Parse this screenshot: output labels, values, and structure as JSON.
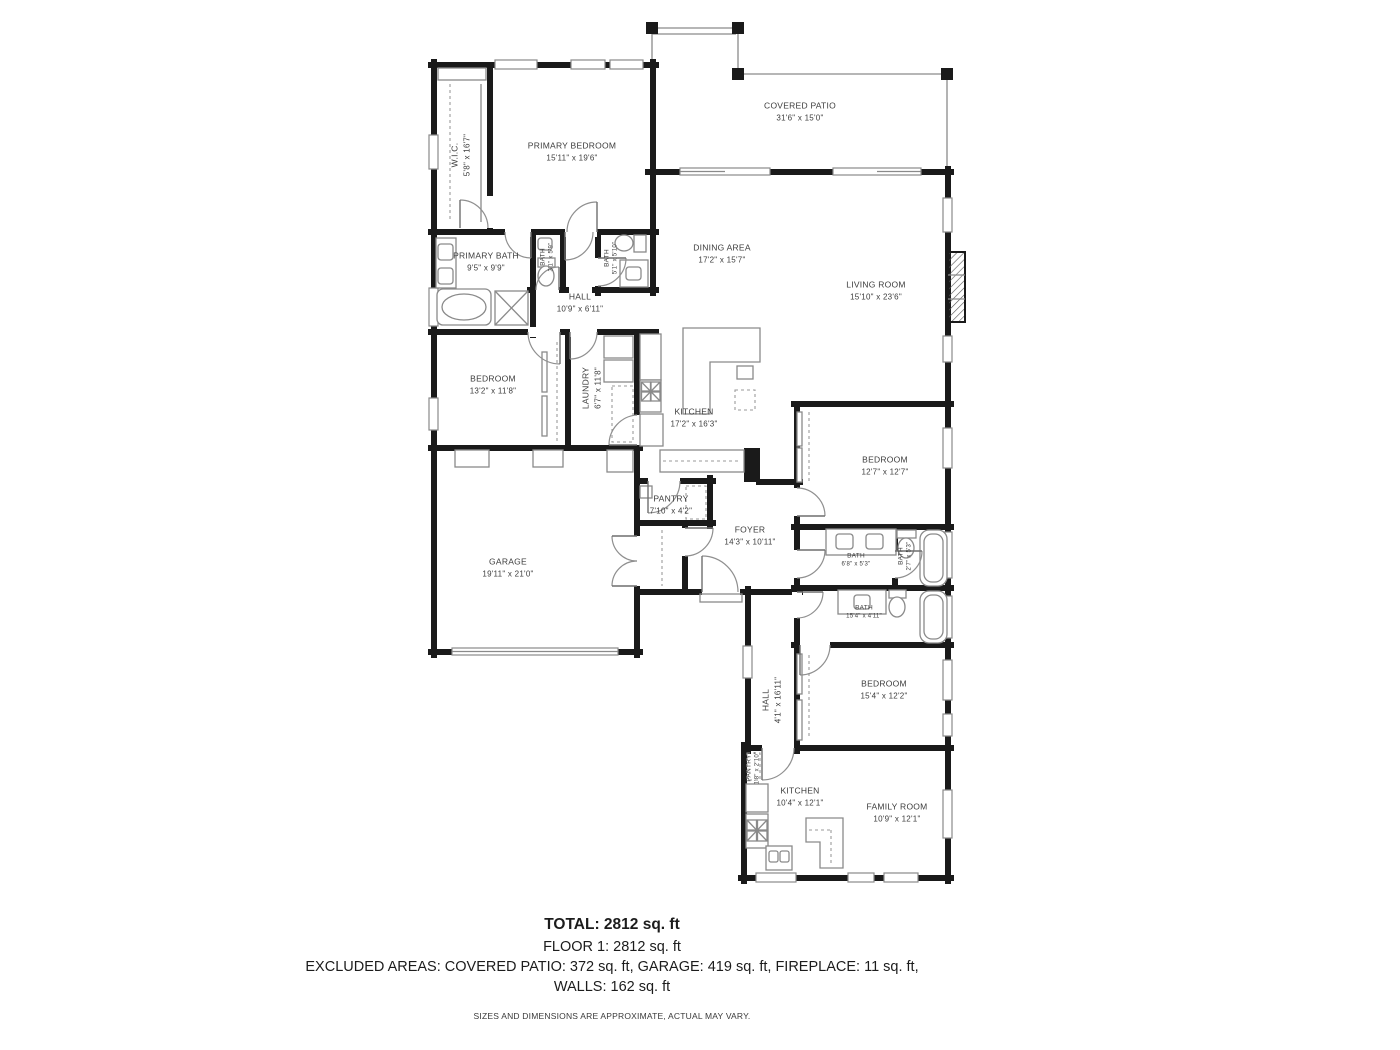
{
  "rooms": {
    "covered_patio": {
      "name": "COVERED PATIO",
      "dims": "31'6\" x 15'0\""
    },
    "wic": {
      "name": "W.I.C.",
      "dims": "5'8\" x 16'7\""
    },
    "primary_bedroom": {
      "name": "PRIMARY BEDROOM",
      "dims": "15'11\" x 19'6\""
    },
    "primary_bath": {
      "name": "PRIMARY BATH",
      "dims": "9'5\" x 9'9\""
    },
    "bath_a": {
      "name": "BATH",
      "dims": "3'1\" x 5'9\""
    },
    "bath_b": {
      "name": "BATH",
      "dims": "5'1\" x 5'10\""
    },
    "hall_upper": {
      "name": "HALL",
      "dims": "10'9\" x 6'11\""
    },
    "dining": {
      "name": "DINING AREA",
      "dims": "17'2\" x 15'7\""
    },
    "living": {
      "name": "LIVING ROOM",
      "dims": "15'10\" x 23'6\""
    },
    "bedroom_left": {
      "name": "BEDROOM",
      "dims": "13'2\" x 11'8\""
    },
    "laundry": {
      "name": "LAUNDRY",
      "dims": "6'7\" x 11'8\""
    },
    "kitchen_main": {
      "name": "KITCHEN",
      "dims": "17'2\" x 16'3\""
    },
    "garage": {
      "name": "GARAGE",
      "dims": "19'11\" x 21'0\""
    },
    "pantry_main": {
      "name": "PANTRY",
      "dims": "7'10\" x 4'2\""
    },
    "foyer": {
      "name": "FOYER",
      "dims": "14'3\" x 10'11\""
    },
    "bedroom_right": {
      "name": "BEDROOM",
      "dims": "12'7\" x 12'7\""
    },
    "bath_c": {
      "name": "BATH",
      "dims": "6'8\" x 5'3\""
    },
    "bath_d": {
      "name": "BATH",
      "dims": "2'7\" x 5'3\""
    },
    "bath_e": {
      "name": "BATH",
      "dims": "15'4\" x 4'11\""
    },
    "bedroom_lower": {
      "name": "BEDROOM",
      "dims": "15'4\" x 12'2\""
    },
    "hall_lower": {
      "name": "HALL",
      "dims": "4'1\" x 16'11\""
    },
    "pantry_lower": {
      "name": "PANTRY",
      "dims": "1'8\" x 2'10\""
    },
    "kitchen_lower": {
      "name": "KITCHEN",
      "dims": "10'4\" x 12'1\""
    },
    "family_room": {
      "name": "FAMILY ROOM",
      "dims": "10'9\" x 12'1\""
    }
  },
  "footer": {
    "total": "TOTAL: 2812 sq. ft",
    "floor": "FLOOR 1: 2812 sq. ft",
    "excluded": "EXCLUDED AREAS: COVERED PATIO: 372 sq. ft, GARAGE: 419 sq. ft, FIREPLACE: 11 sq. ft,",
    "walls": "WALLS: 162 sq. ft",
    "disclaimer": "SIZES AND DIMENSIONS ARE APPROXIMATE, ACTUAL MAY VARY."
  }
}
